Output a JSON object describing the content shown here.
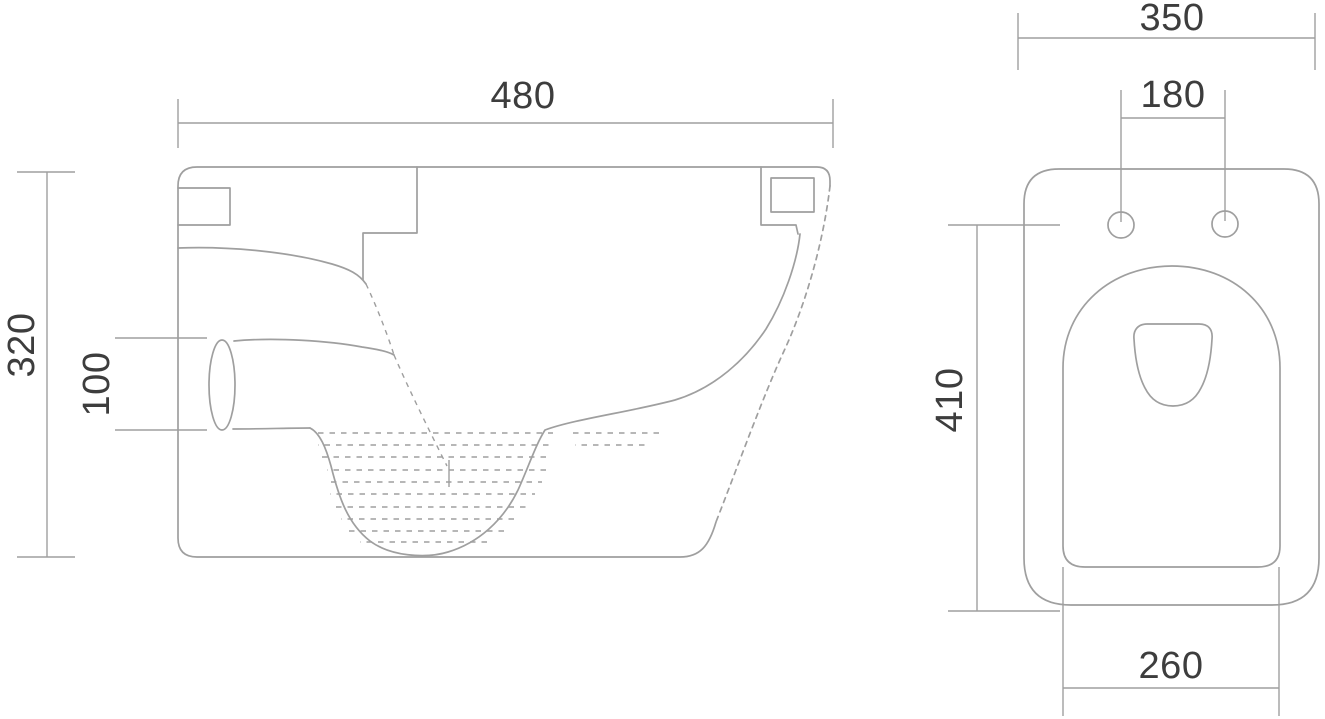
{
  "colors": {
    "background": "#ffffff",
    "line": "#9f9f9f",
    "text": "#3d3d3d"
  },
  "drawing": {
    "type": "technical_drawing",
    "views": [
      {
        "id": "side-view",
        "name": "side section view"
      },
      {
        "id": "top-view",
        "name": "top plan view"
      }
    ]
  },
  "side_view": {
    "dims": {
      "width": "480",
      "height": "320",
      "outlet_height": "100"
    }
  },
  "top_view": {
    "dims": {
      "width": "350",
      "hole_spacing": "180",
      "length": "410",
      "bottom_width": "260"
    }
  }
}
